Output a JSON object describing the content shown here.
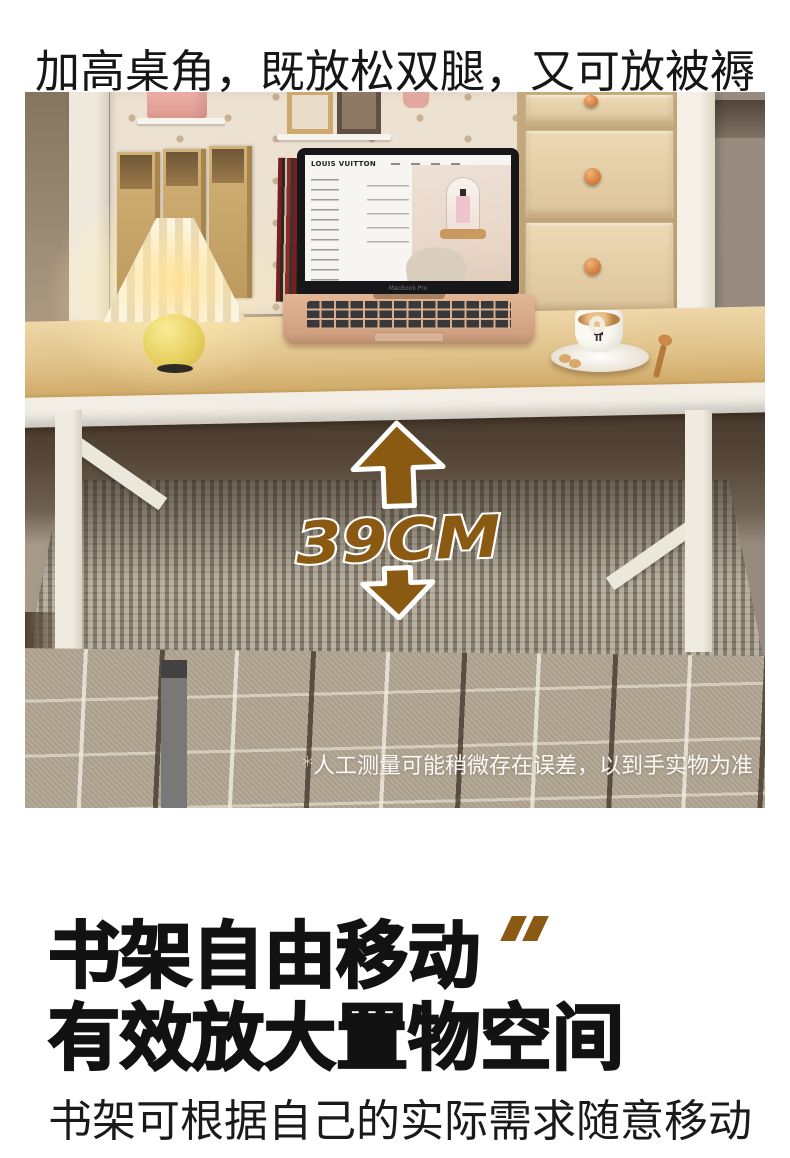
{
  "page": {
    "title": "加高桌角，既放松双腿，又可放被褥",
    "headline1": "书架自由移动",
    "headline2": "有效放大置物空间",
    "subheadline": "书架可根据自己的实际需求随意移动"
  },
  "photo": {
    "measurement": "39CM",
    "disclaimer": "*人工测量可能稍微存在误差，以到手实物为准",
    "laptop_brand": "LOUIS VUITTON",
    "laptop_model": "MacBook Pro"
  },
  "colors": {
    "accent_gold": "#8a5a12",
    "wall_taupe": "#9a9083",
    "pegboard_cream": "#ede1d1",
    "desk_wood": "#e0c28a",
    "frame_white": "#f2eee5",
    "mattress_gray": "#8d8578",
    "blanket_tan": "#b2a692"
  }
}
